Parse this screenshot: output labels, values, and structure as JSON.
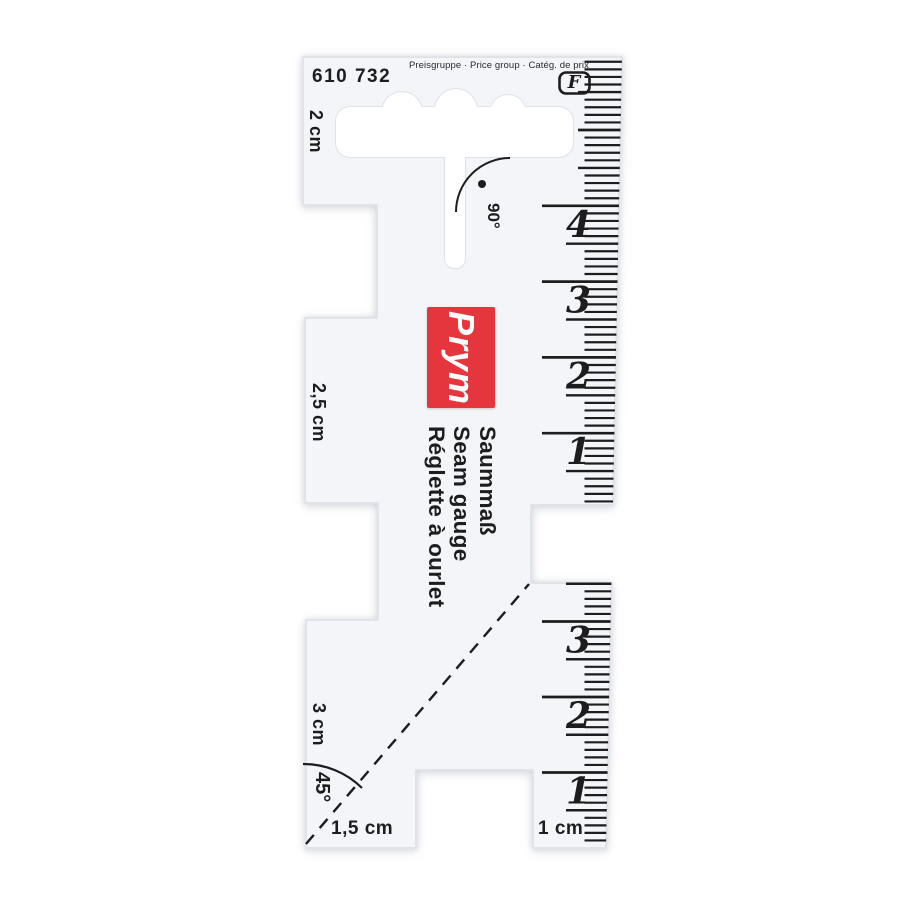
{
  "product": {
    "article_number": "610 732",
    "price_group_label": "Preisgruppe · Price group · Catég. de prix",
    "price_group_code": "F",
    "brand": "Prym",
    "names": [
      "Saummaß",
      "Seam gauge",
      "Réglette à ourlet"
    ]
  },
  "labels": {
    "top_notch": "2 cm",
    "middle_notch": "2,5 cm",
    "lower_notch": "3 cm",
    "bottom_left": "1,5 cm",
    "bottom_right": "1 cm",
    "right_angle": "90°",
    "diagonal_angle": "45°"
  },
  "scales": {
    "upper": {
      "unit": "cm",
      "numbers": [
        "4",
        "3",
        "2",
        "1"
      ]
    },
    "lower": {
      "unit": "cm",
      "numbers": [
        "3",
        "2",
        "1"
      ]
    }
  },
  "colors": {
    "brand_red": "#e6363d",
    "ink": "#1d1d1f",
    "ruler_body": "#f3f5f8"
  }
}
